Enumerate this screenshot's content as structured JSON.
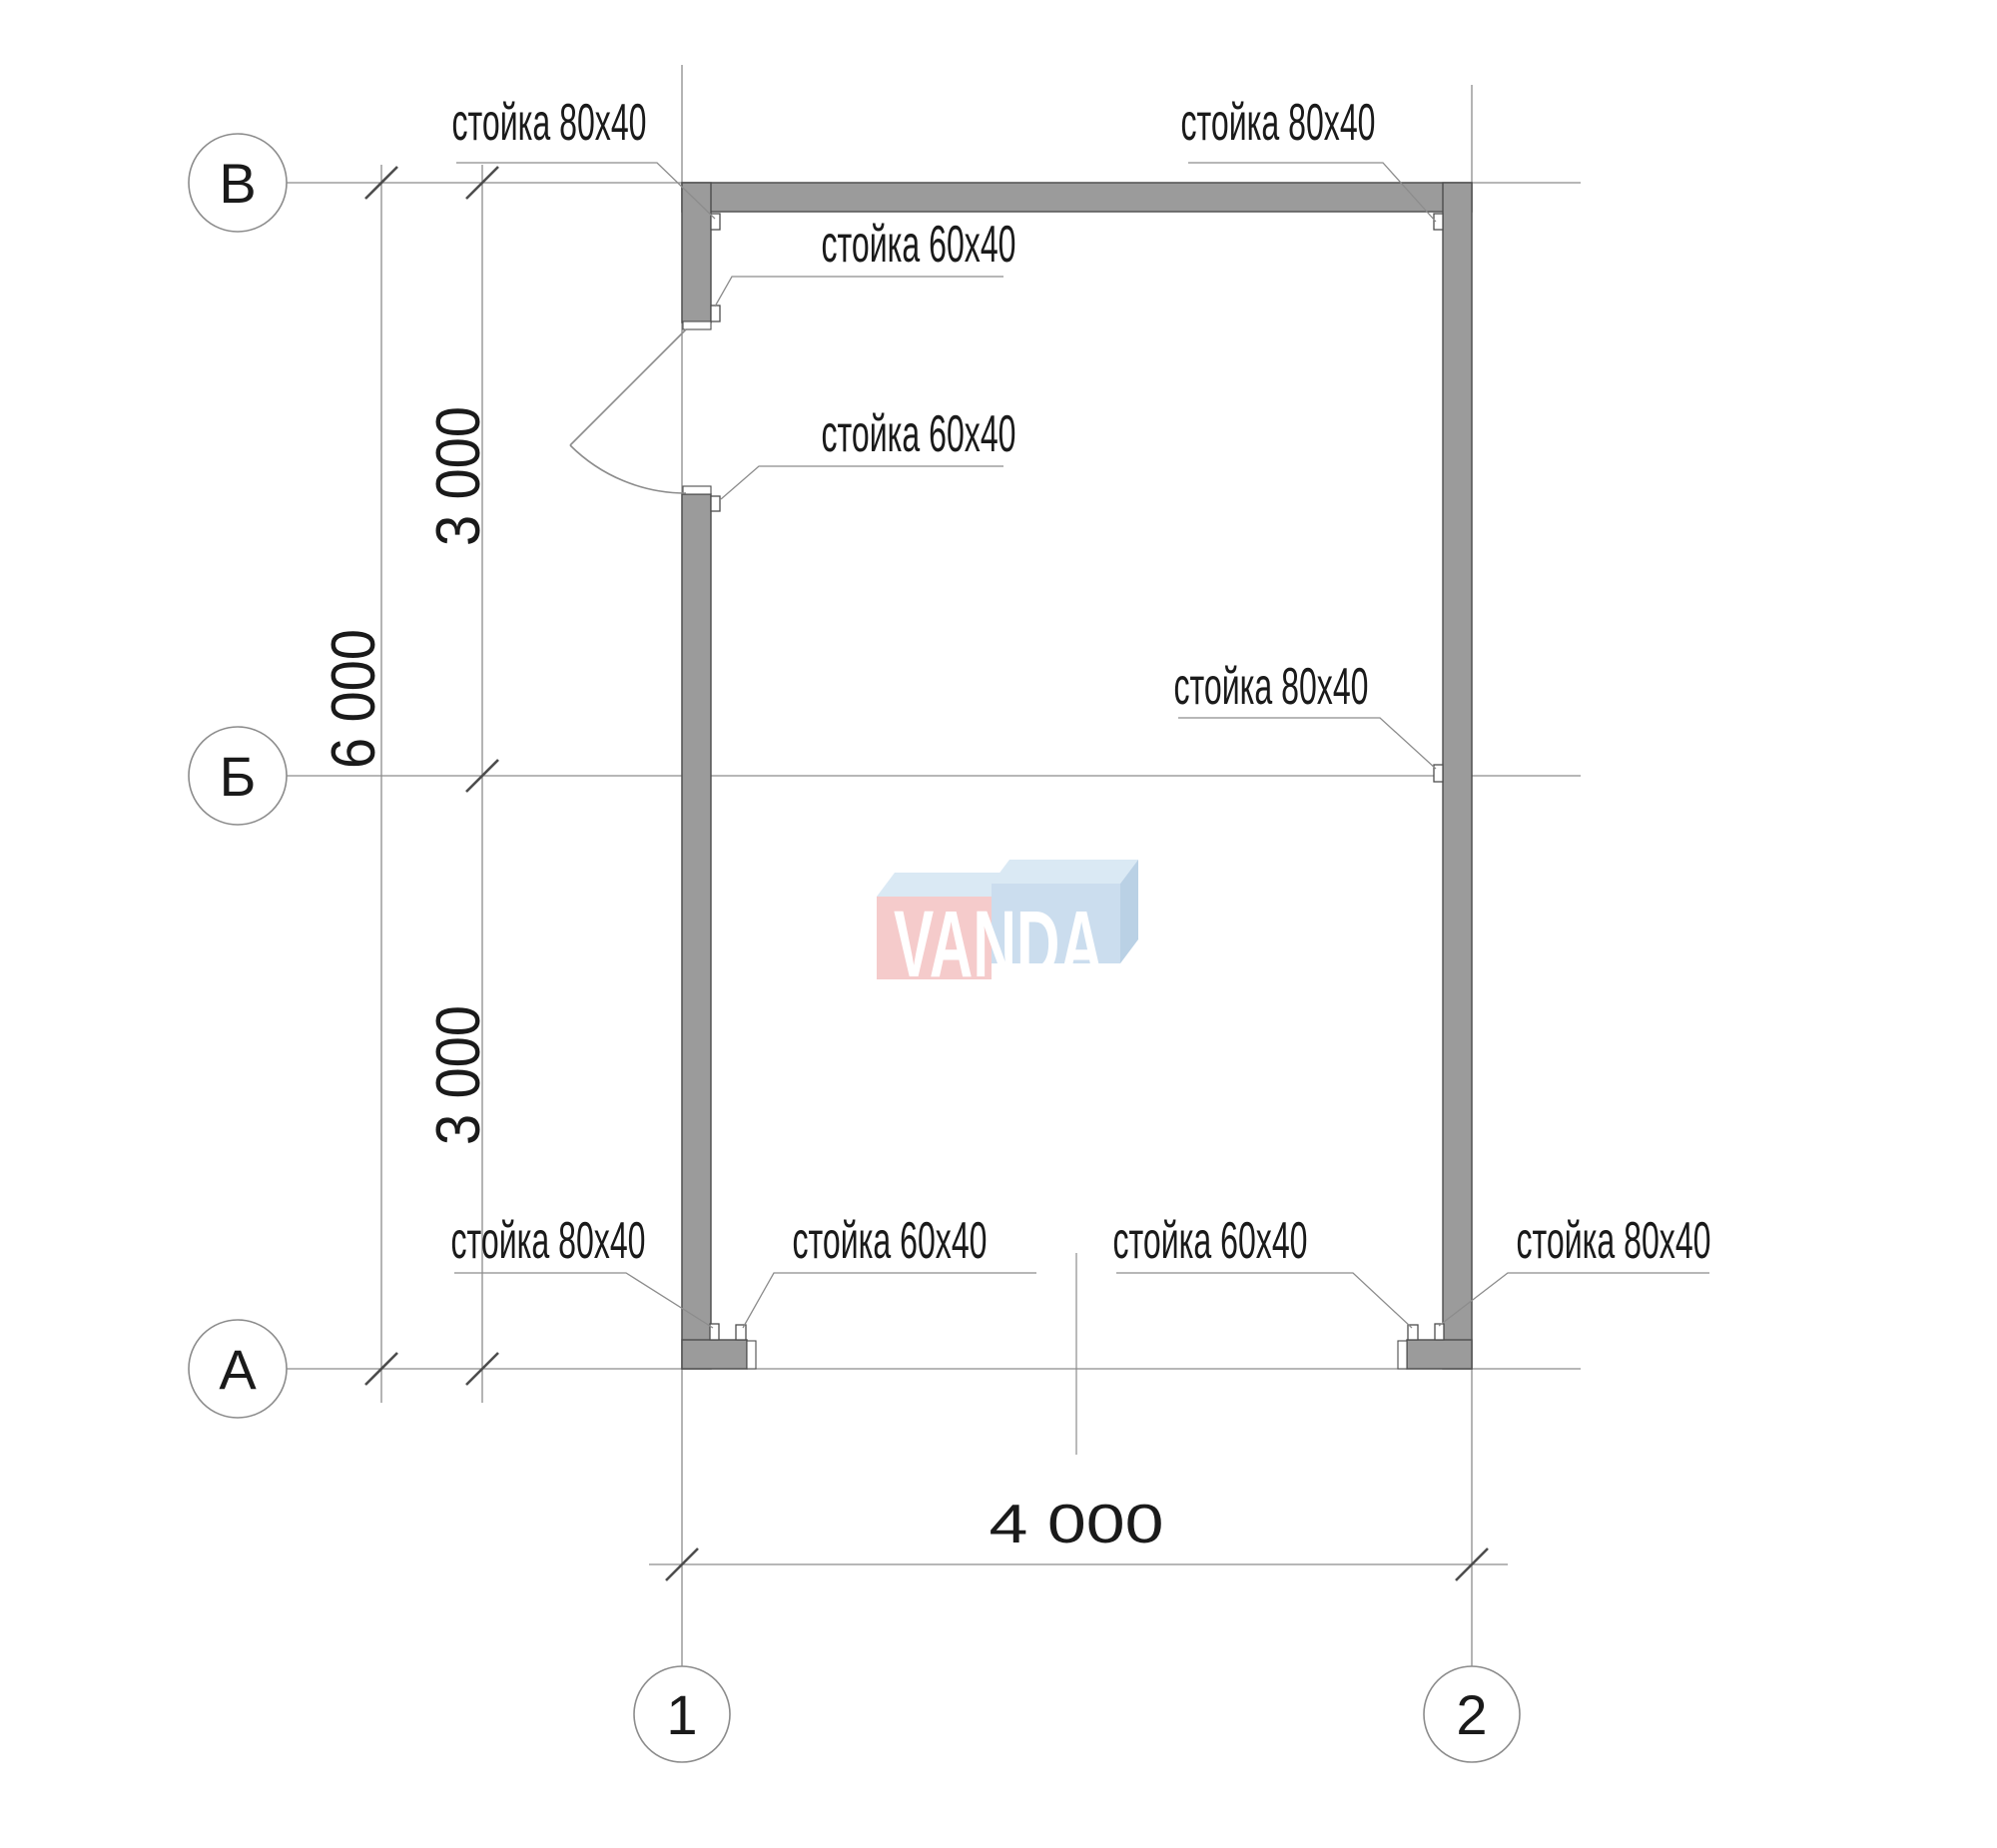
{
  "colors": {
    "wall_fill": "#9b9b9b",
    "line": "#8c8c8c",
    "dark_line": "#4d4d4d",
    "text": "#1a1a1a",
    "watermark_pink": "#f5c9c9",
    "watermark_blue": "#c9dcee",
    "watermark_top": "#d9e8f4",
    "watermark_blue_side": "#b7cfe4",
    "watermark_text": "#ffffff"
  },
  "drawing": {
    "axis_bubbles": [
      {
        "label": "В"
      },
      {
        "label": "Б"
      },
      {
        "label": "А"
      },
      {
        "label": "1"
      },
      {
        "label": "2"
      }
    ],
    "dimensions": {
      "vertical_upper": "3 000",
      "vertical_overall": "6 000",
      "vertical_lower": "3 000",
      "horizontal_overall": "4 000"
    },
    "callouts": [
      {
        "id": "top-left-corner",
        "text": "стойка 80х40"
      },
      {
        "id": "top-right-corner",
        "text": "стойка 80х40"
      },
      {
        "id": "door-top-jamb",
        "text": "стойка 60х40"
      },
      {
        "id": "door-bottom-jamb",
        "text": "стойка 60х40"
      },
      {
        "id": "right-middle",
        "text": "стойка 80х40"
      },
      {
        "id": "bottom-left-corner",
        "text": "стойка 80х40"
      },
      {
        "id": "bottom-left-jamb",
        "text": "стойка 60х40"
      },
      {
        "id": "bottom-right-jamb",
        "text": "стойка 60х40"
      },
      {
        "id": "bottom-right-corner",
        "text": "стойка 80х40"
      }
    ],
    "watermark": {
      "text": "VANDA"
    }
  }
}
